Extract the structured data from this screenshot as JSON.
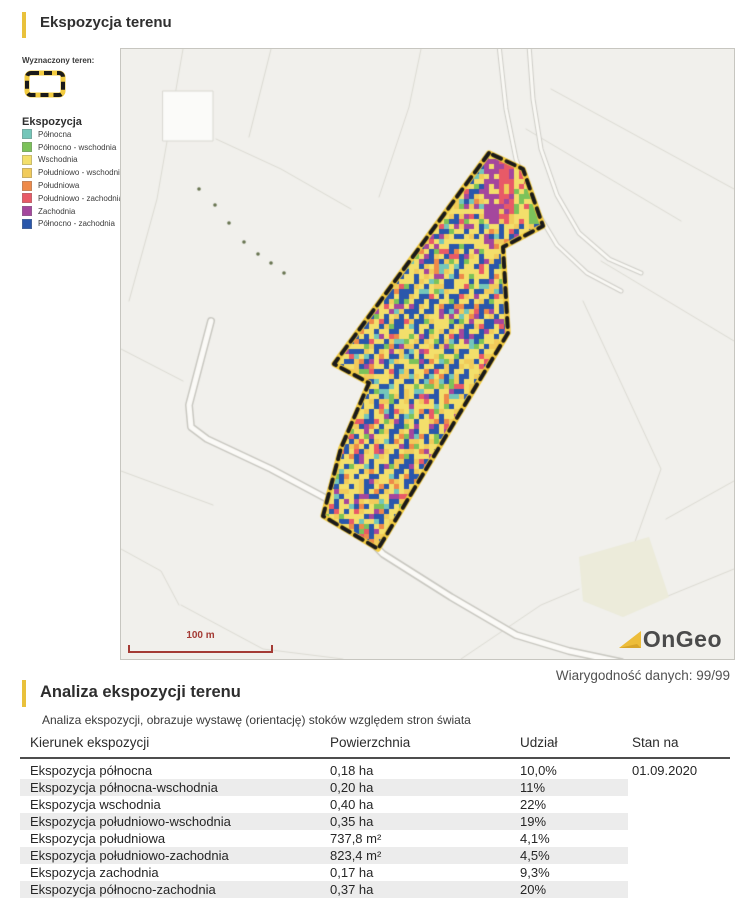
{
  "page": {
    "title": "Ekspozycja terenu"
  },
  "map": {
    "legend": {
      "area_label": "Wyznaczony teren:",
      "exposure_label": "Ekspozycja",
      "items": [
        {
          "label": "Północna",
          "color": "#74c6b9"
        },
        {
          "label": "Północno - wschodnia",
          "color": "#7cc25a"
        },
        {
          "label": "Wschodnia",
          "color": "#f3df6b"
        },
        {
          "label": "Południowo - wschodnia",
          "color": "#f1cb5b"
        },
        {
          "label": "Południowa",
          "color": "#ee8a4a"
        },
        {
          "label": "Południowo - zachodnia",
          "color": "#e85a67"
        },
        {
          "label": "Zachodnia",
          "color": "#a4479d"
        },
        {
          "label": "Północno - zachodnia",
          "color": "#2a57ab"
        }
      ],
      "outline_yellow": "#f2cb3f",
      "outline_black": "#1a1a1a"
    },
    "scale_label": "100 m",
    "scale_color": "#a43b35",
    "logo_text": "OnGeo",
    "logo_triangle_color": "#edbd3a"
  },
  "section": {
    "reliability": "Wiarygodność danych: 99/99",
    "title": "Analiza ekspozycji terenu",
    "subtitle": "Analiza ekspozycji, obrazuje wystawę (orientację) stoków względem stron świata",
    "accent_color": "#e9c13b"
  },
  "table": {
    "columns": [
      "Kierunek ekspozycji",
      "Powierzchnia",
      "Udział",
      "Stan na"
    ],
    "rows": [
      {
        "direction": "Ekspozycja północna",
        "area": "0,18 ha",
        "share": "10,0%",
        "as_of": "01.09.2020"
      },
      {
        "direction": "Ekspozycja północna-wschodnia",
        "area": "0,20 ha",
        "share": "11%",
        "as_of": ""
      },
      {
        "direction": "Ekspozycja wschodnia",
        "area": "0,40 ha",
        "share": "22%",
        "as_of": ""
      },
      {
        "direction": "Ekspozycja południowo-wschodnia",
        "area": "0,35 ha",
        "share": "19%",
        "as_of": ""
      },
      {
        "direction": "Ekspozycja południowa",
        "area": "737,8 m²",
        "share": "4,1%",
        "as_of": ""
      },
      {
        "direction": "Ekspozycja południowo-zachodnia",
        "area": "823,4 m²",
        "share": "4,5%",
        "as_of": ""
      },
      {
        "direction": "Ekspozycja zachodnia",
        "area": "0,17 ha",
        "share": "9,3%",
        "as_of": ""
      },
      {
        "direction": "Ekspozycja północno-zachodnia",
        "area": "0,37 ha",
        "share": "20%",
        "as_of": ""
      }
    ]
  }
}
